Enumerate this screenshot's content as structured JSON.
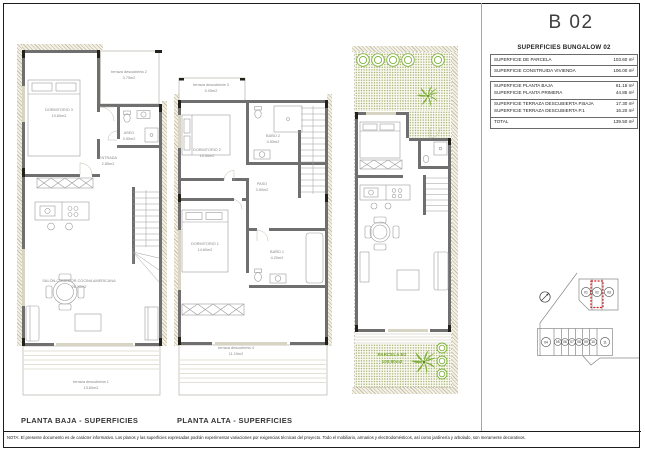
{
  "sheet": {
    "unit_title": "B 02",
    "footer_note": "NOTA: El presente documento es de carácter informativo. Los planos y las superficies expresadas podrán experimentar variaciones por exigencias técnicas del proyecto. Todo el mobiliario, armarios y electrodomésticos, así como jardinería y arbolado, son meramente decorativos."
  },
  "surfaces_table": {
    "title": "SUPERFICIES BUNGALOW 02",
    "rows": [
      {
        "label": "SUPERFICIE DE PARCELA",
        "value": "103.60 m²"
      },
      {
        "label": "SUPERFICIE CONSTRUIDA VIVIENDA",
        "value": "106.00 m²"
      },
      {
        "label": "SUPERFICIE PLANTA BAJA",
        "value": "61.15 m²"
      },
      {
        "label": "SUPERFICIE PLANTA PRIMERA",
        "value": "44.85 m²"
      },
      {
        "label": "SUPERFICIE TERRAZA DESCUBIERTA P.BAJA",
        "value": "17.30 m²"
      },
      {
        "label": "SUPERFICIE TERRAZA DESCUBIERTA P.1",
        "value": "16.20 m²"
      },
      {
        "label": "TOTAL",
        "value": "139.50 m²"
      }
    ]
  },
  "planta_baja": {
    "caption": "PLANTA BAJA - SUPERFICIES",
    "rooms": {
      "dormitorio3": {
        "name": "DORMITORIO 3",
        "area": "10.60m2"
      },
      "terraza2": {
        "name": "terraza descubierta 2",
        "area": "3.70m2"
      },
      "aseo": {
        "name": "ASEO",
        "area": "3.50m2"
      },
      "entrada": {
        "name": "ENTRADA",
        "area": "2.85m2"
      },
      "salon": {
        "name": "SALÓN-COMEDOR-COCINA AMERICANA",
        "area": "26.10m2"
      },
      "terraza1": {
        "name": "terraza descubierta 1",
        "area": "13.60m2"
      }
    }
  },
  "planta_alta": {
    "caption": "PLANTA ALTA - SUPERFICIES",
    "rooms": {
      "terraza3": {
        "name": "terraza descubierta 3",
        "area": "5.05m2"
      },
      "dormitorio2": {
        "name": "DORMITORIO 2",
        "area": "10.50m2"
      },
      "bano2": {
        "name": "BAÑO 2",
        "area": "4.50m2"
      },
      "paso": {
        "name": "PASO",
        "area": "3.50m2"
      },
      "dormitorio1": {
        "name": "DORMITORIO 1",
        "area": "14.60m2"
      },
      "bano1": {
        "name": "BAÑO 1",
        "area": "4.20m2"
      },
      "terraza4": {
        "name": "terraza descubierta 4",
        "area": "11.15m2"
      }
    }
  },
  "parcela": {
    "name": "PARCELA B2",
    "area": "103.60m2"
  },
  "key_plan": {
    "top_units": [
      "01",
      "02",
      "03"
    ],
    "highlighted_unit": "02",
    "bottom_units": [
      "04",
      "05",
      "06",
      "07",
      "08",
      "09",
      "10",
      "11"
    ]
  },
  "colors": {
    "accent_green": "#7fb13a",
    "highlight_red": "#d2232a",
    "wall_gray": "#6f6f6f"
  }
}
